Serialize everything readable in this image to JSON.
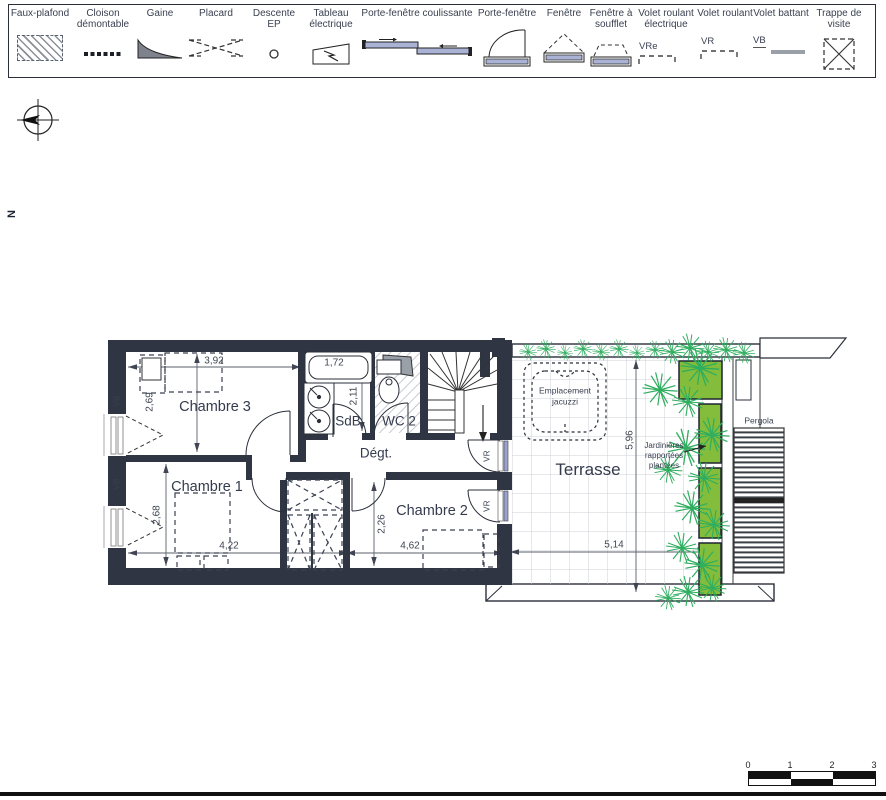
{
  "legend": {
    "items": [
      {
        "label": "Faux-plafond",
        "icon": "hatched-rect"
      },
      {
        "label": "Cloison démontable",
        "icon": "dotted-line"
      },
      {
        "label": "Gaine",
        "icon": "duct-wedge"
      },
      {
        "label": "Placard",
        "icon": "dashed-cross"
      },
      {
        "label": "Descente EP",
        "icon": "small-circle"
      },
      {
        "label": "Tableau électrique",
        "icon": "electric-panel"
      },
      {
        "label": "Porte-fenêtre coulissante",
        "icon": "sliding-door"
      },
      {
        "label": "Porte-fenêtre",
        "icon": "french-door"
      },
      {
        "label": "Fenêtre",
        "icon": "window"
      },
      {
        "label": "Fenêtre à soufflet",
        "icon": "awning-window"
      },
      {
        "label": "Volet roulant électrique",
        "icon": "shutter-electric",
        "symbol_text": "VRe"
      },
      {
        "label": "Volet roulant",
        "icon": "shutter-roller",
        "symbol_text": "VR"
      },
      {
        "label": "Volet battant",
        "icon": "shutter-swing",
        "symbol_text": "VB"
      },
      {
        "label": "Trappe de visite",
        "icon": "access-hatch"
      }
    ]
  },
  "compass": {
    "north": "N"
  },
  "plan": {
    "rooms": {
      "chambre3": "Chambre 3",
      "chambre1": "Chambre 1",
      "chambre2": "Chambre 2",
      "sdb": "SdB",
      "wc2": "WC 2",
      "degagement": "Dégt.",
      "terrasse": "Terrasse"
    },
    "annotations": {
      "jacuzzi": "Emplacement jacuzzi",
      "jardinieres": "Jardinières rapportées plantées",
      "pergola": "Pergola"
    },
    "shutter_tags": {
      "vb": "VB",
      "vr": "VR"
    },
    "dimensions": {
      "ch3_width": "3,92",
      "bath_length": "1,72",
      "ch3_depth": "2,69",
      "sdb_depth": "2,11",
      "ch1_depth": "2,68",
      "ch1_width": "4,22",
      "ch2_width": "4,62",
      "ch2_depth": "2,26",
      "terrasse_depth": "5,96",
      "terrasse_width": "5,14"
    }
  },
  "scale_bar": {
    "ticks": [
      "0",
      "1",
      "2",
      "3"
    ]
  },
  "colors": {
    "wall": "#2f3542",
    "glazing": "#9aa3cf",
    "planter_fill": "#83bd3b",
    "plant_stroke": "#2fae5f",
    "line": "#2a2f3a"
  }
}
